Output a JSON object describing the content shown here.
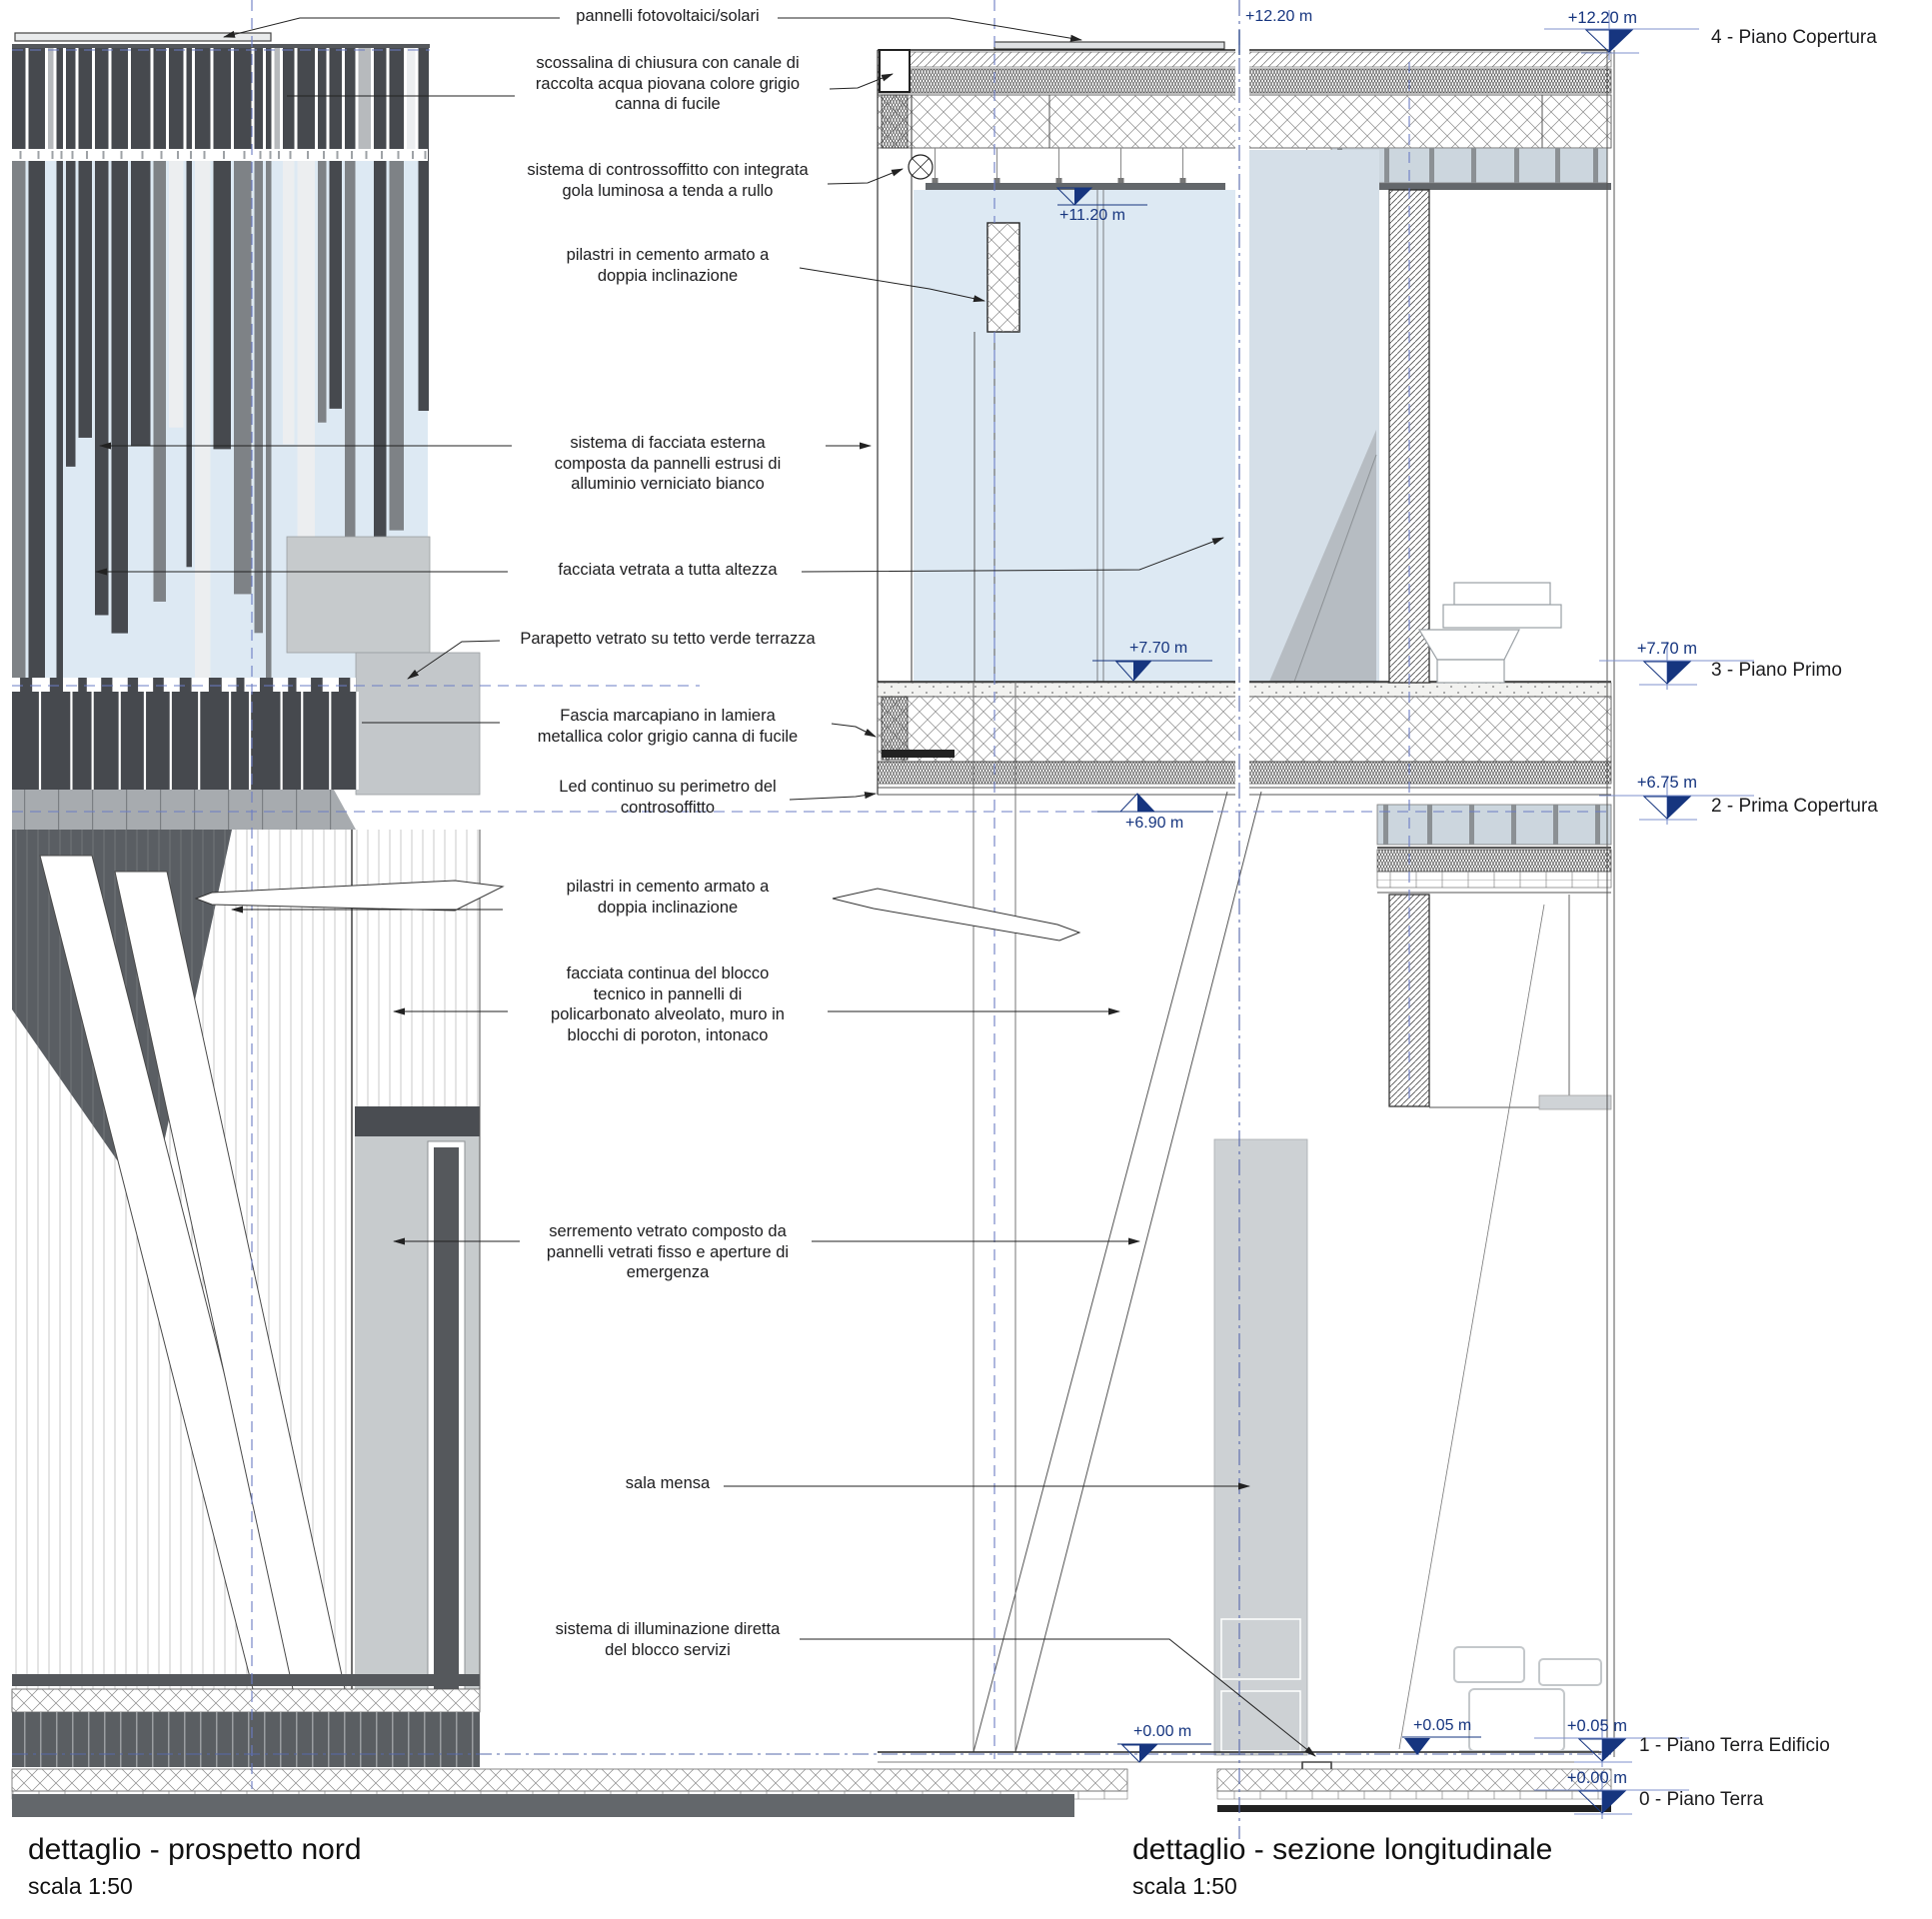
{
  "drawings": {
    "left": {
      "title": "dettaglio - prospetto nord",
      "scale": "scala 1:50"
    },
    "right": {
      "title": "dettaglio - sezione longitudinale",
      "scale": "scala 1:50"
    }
  },
  "annotations": [
    {
      "text": "pannelli fotovoltaici/solari"
    },
    {
      "text": "scossalina di chiusura con canale di\nraccolta acqua piovana colore grigio\ncanna di fucile"
    },
    {
      "text": "sistema di controssoffitto con integrata\ngola luminosa a tenda a rullo"
    },
    {
      "text": "pilastri in cemento armato a\ndoppia inclinazione"
    },
    {
      "text": "sistema di facciata esterna\ncomposta da pannelli estrusi di\nalluminio verniciato bianco"
    },
    {
      "text": "facciata vetrata a tutta altezza"
    },
    {
      "text": "Parapetto vetrato su tetto verde terrazza"
    },
    {
      "text": "Fascia marcapiano in lamiera\nmetallica color grigio canna di fucile"
    },
    {
      "text": "Led continuo su perimetro del\ncontrosoffitto"
    },
    {
      "text": "pilastri in cemento armato a\ndoppia inclinazione"
    },
    {
      "text": "facciata continua del blocco\ntecnico in pannelli di\npolicarbonato alveolato, muro in\nblocchi di poroton, intonaco"
    },
    {
      "text": "serremento vetrato composto da\npannelli vetrati fisso e aperture di\nemergenza"
    },
    {
      "text": "sala mensa"
    },
    {
      "text": "sistema di illuminazione diretta\ndel blocco servizi"
    }
  ],
  "section_marks": [
    {
      "value": "+12.20 m"
    },
    {
      "value": "+11.20 m"
    },
    {
      "value": "+7.70 m"
    },
    {
      "value": "+6.90 m"
    },
    {
      "value": "+0.05 m"
    },
    {
      "value": "+0.00 m"
    }
  ],
  "levels": [
    {
      "value": "+12.20 m",
      "label": "4 - Piano Copertura"
    },
    {
      "value": "+7.70 m",
      "label": "3 - Piano Primo"
    },
    {
      "value": "+6.75 m",
      "label": "2 - Prima Copertura"
    },
    {
      "value": "+0.05 m",
      "label": "1 - Piano Terra Edificio"
    },
    {
      "value": "+0.00 m",
      "label": "0 - Piano Terra"
    }
  ],
  "colors": {
    "marker_navy": "#16357f",
    "dash_blue": "#6b7cc4",
    "axis_blue": "#5668ab",
    "slat_dark": "#46494e",
    "panel_gray": "#c6cacc",
    "glass_blue": "#dde9f3",
    "ink": "#1c1c1e"
  }
}
